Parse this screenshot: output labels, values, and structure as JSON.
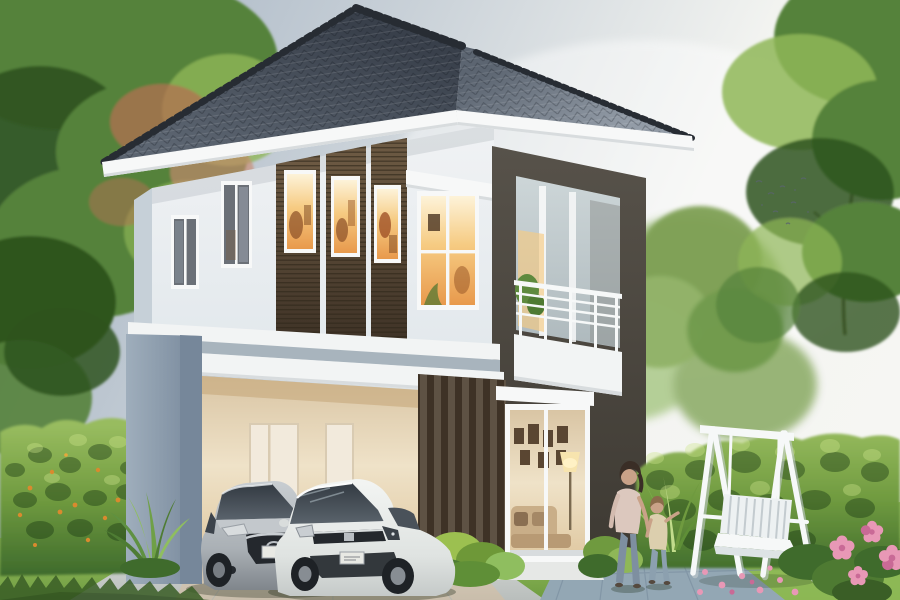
{
  "canvas": {
    "width": 900,
    "height": 600
  },
  "scene": {
    "type": "architectural-rendering-photo",
    "subject": "Modern two-story house with dark hipped tile roof, lit windows, balcony, open carport with a silver sedan and a white hatchback, garden hedges, white A-frame swing bench, and a woman walking with a child",
    "text_content": "none visible",
    "palette": {
      "sky_top": "#9FAEBF",
      "sky_mid": "#C9D1D8",
      "sky_bright": "#F3F4F1",
      "roof_dark": "#39404B",
      "roof_mid": "#5C6571",
      "roof_light": "#939CA7",
      "ridge": "#272C33",
      "fascia": "#F7F8F8",
      "fascia_shadow": "#D8DCDE",
      "wall_light": "#F0F2F4",
      "wall_mid": "#E2E8EC",
      "wall_shadow": "#C6D0D8",
      "slab_white": "#F2F4F4",
      "ceiling_shadow": "#A8B4BD",
      "column_light": "#9FAEBC",
      "column_dark": "#76879A",
      "tower_light": "#57524A",
      "tower_dark": "#3E3A33",
      "slat_light": "#6E5B44",
      "slat_dark": "#3E3226",
      "louver_dark": "#2F2619",
      "warm_pale": "#FDF3D9",
      "warm_mid": "#F6CB82",
      "warm_deep": "#E8994C",
      "interior_cream": "#EFE2C8",
      "interior_tan": "#D9C5A4",
      "door_white": "#F2EADC",
      "balcony_glass": "#CDD6D8",
      "balcony_glass_dark": "#AEB9BD",
      "railing": "#F6F8F8",
      "glass_cool": "#6B7077",
      "lawn_light": "#9CC261",
      "lawn_dark": "#6E9C41",
      "hedge_light": "#98BC5F",
      "hedge_mid": "#6F9A3F",
      "hedge_dark": "#3F6B2C",
      "tree_light": "#8FB757",
      "tree_mid": "#55823A",
      "tree_dark": "#2E541F",
      "tree_red": "#B56F52",
      "drive_light": "#D6D9D6",
      "drive_dark": "#B9BEBC",
      "warm_glow": "#E7BE8C",
      "tile_blue": "#93A7B4",
      "tile_line": "#7B8FA0",
      "car_silver": "#C9CED2",
      "car_silver_dark": "#7A8086",
      "car_white": "#F4F6F4",
      "car_white_dark": "#C2C7C6",
      "car_glass": "#3E454D",
      "car_black": "#24282D",
      "plate_white": "#E8E9E4",
      "swing_white": "#F6F8F8",
      "swing_shadow": "#C3CBCF",
      "skin": "#C9A288",
      "hair_brown": "#3A2E26",
      "hair_child": "#8A6B4A",
      "woman_top": "#DCC8BE",
      "child_top": "#DCCFAE",
      "jeans": "#7E8FA0",
      "flower_pink": "#E898B6",
      "flower_deep": "#C96A96",
      "flower_orange": "#D98A2E"
    },
    "elements": {
      "sky": "bright overcast sky, blue-gray upper left fading to white on the right",
      "trees": {
        "left_foreground": "large green tree with reddish-pink blossom patches, top-left",
        "right_foreground": "tall green leafy tree along right edge",
        "background": "soft blurred green trees behind the house"
      },
      "house": {
        "stories": 2,
        "roof": "dark blue-gray hipped tile roof with ornamental serrated ridge caps and white fascia",
        "upper_floor": {
          "small_windows": 2,
          "slat_panels_with_lit_windows": 3,
          "large_lit_window": "white four-pane window with white awning, warm interior light"
        },
        "balcony": "dark brown-gray framed recess with white horizontal-bar railing, white parapet, glass door and plant",
        "ground_floor": {
          "carport": "open carport with warm lit cream interior and two interior doors",
          "slat_screen": "dark vertical-fin screen wall",
          "sliding_glass_door": "white-framed glass door showing lit living room with gallery wall, floor lamp and sofa",
          "column": "gray-blue carport column"
        }
      },
      "vehicles": [
        {
          "kind": "sedan",
          "color": "silver",
          "position": "parked in carport, left"
        },
        {
          "kind": "hatchback",
          "color": "white",
          "position": "parked in carport, right"
        }
      ],
      "people": [
        {
          "kind": "woman",
          "clothing": "light pink top and jeans",
          "action": "walking, holding child's hand"
        },
        {
          "kind": "child",
          "clothing": "beige top and jeans",
          "action": "walking beside woman"
        }
      ],
      "garden": {
        "swing": "white wooden A-frame swing bench on lawn",
        "hedges": "trimmed green hedges left and right",
        "flowers": "orange accent flowers on left hedge, pink blooms at bottom right",
        "plants": "spiky green plant by the column, bright shrub under the slat screen, striped tropical plant near the people",
        "paving": "light concrete driveway and blue-gray tiled walkway"
      },
      "birds": "small flock of distant birds in upper right sky"
    }
  }
}
